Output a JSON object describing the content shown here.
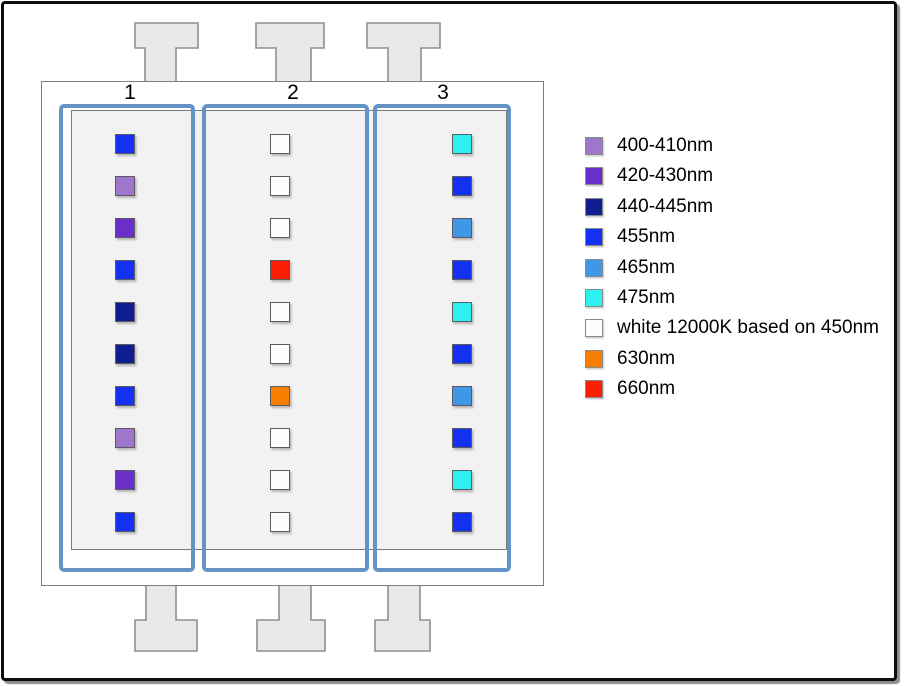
{
  "diagram": {
    "channel_labels": [
      "1",
      "2",
      "3"
    ],
    "palette": {
      "400-410nm": "#9e77cd",
      "420-430nm": "#6a2fc8",
      "440-445nm": "#101f90",
      "455nm": "#1430f2",
      "465nm": "#4097e8",
      "475nm": "#2df1ef",
      "white 12000K based on 450nm": "#fdfcfe",
      "630nm": "#f87d00",
      "660nm": "#fa1e04"
    },
    "channel_outline_color": "#6493c7",
    "channels": [
      {
        "label": "1",
        "leds": [
          "455nm",
          "400-410nm",
          "420-430nm",
          "455nm",
          "440-445nm",
          "440-445nm",
          "455nm",
          "400-410nm",
          "420-430nm",
          "455nm"
        ]
      },
      {
        "label": "2",
        "leds": [
          "white 12000K based on 450nm",
          "white 12000K based on 450nm",
          "white 12000K based on 450nm",
          "660nm",
          "white 12000K based on 450nm",
          "white 12000K based on 450nm",
          "630nm",
          "white 12000K based on 450nm",
          "white 12000K based on 450nm",
          "white 12000K based on 450nm"
        ]
      },
      {
        "label": "3",
        "leds": [
          "475nm",
          "455nm",
          "465nm",
          "455nm",
          "475nm",
          "455nm",
          "465nm",
          "455nm",
          "475nm",
          "455nm"
        ]
      }
    ],
    "legend_items": [
      "400-410nm",
      "420-430nm",
      "440-445nm",
      "455nm",
      "465nm",
      "475nm",
      "white 12000K based on 450nm",
      "630nm",
      "660nm"
    ]
  }
}
